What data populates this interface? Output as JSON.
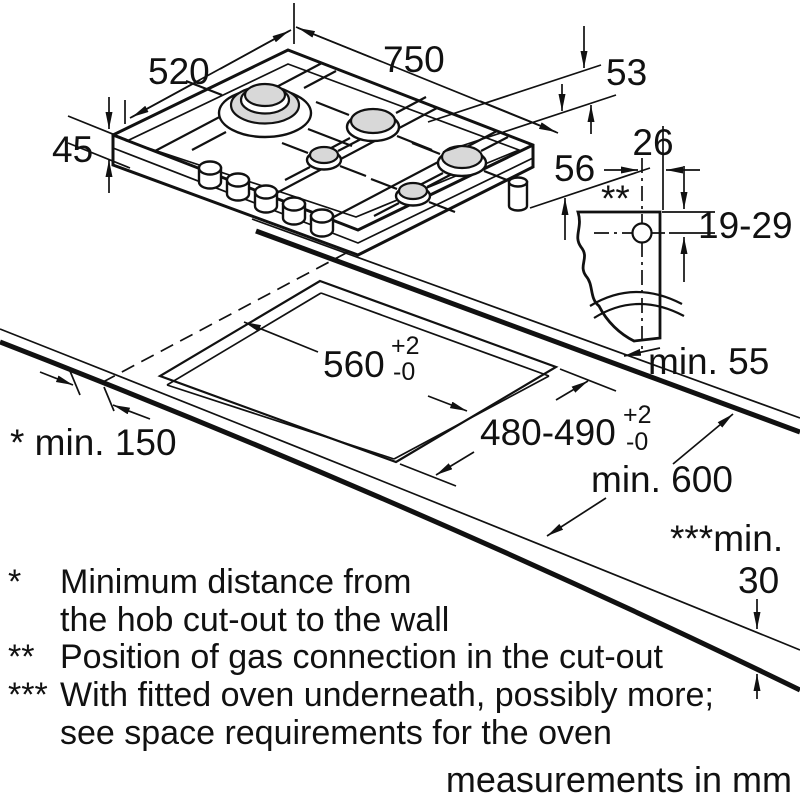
{
  "diagram": {
    "hob": {
      "width": "750",
      "depth": "520",
      "height_above_worktop": "45",
      "height_below_worktop": "53",
      "height_below_with_connection": "56"
    },
    "gas_connection": {
      "offset_from_edge": "26",
      "marker": "**",
      "depth_range": "19-29",
      "rear_clearance": "min. 55"
    },
    "cutout": {
      "width": "560",
      "width_tol_plus": "+2",
      "width_tol_minus": "-0",
      "depth": "480-490",
      "depth_tol_plus": "+2",
      "depth_tol_minus": "-0",
      "side_clearance": "* min. 150"
    },
    "worktop": {
      "depth": "min. 600",
      "oven_clearance_label": "***min.",
      "oven_clearance_value": "30"
    },
    "footnotes": [
      {
        "marker": "*",
        "line1": "Minimum distance from",
        "line2": "the hob cut-out to the wall"
      },
      {
        "marker": "**",
        "line1": "Position of gas connection in the cut-out",
        "line2": ""
      },
      {
        "marker": "***",
        "line1": "With fitted oven underneath, possibly more;",
        "line2": "see space requirements for the oven"
      }
    ],
    "units_note": "measurements in mm"
  }
}
